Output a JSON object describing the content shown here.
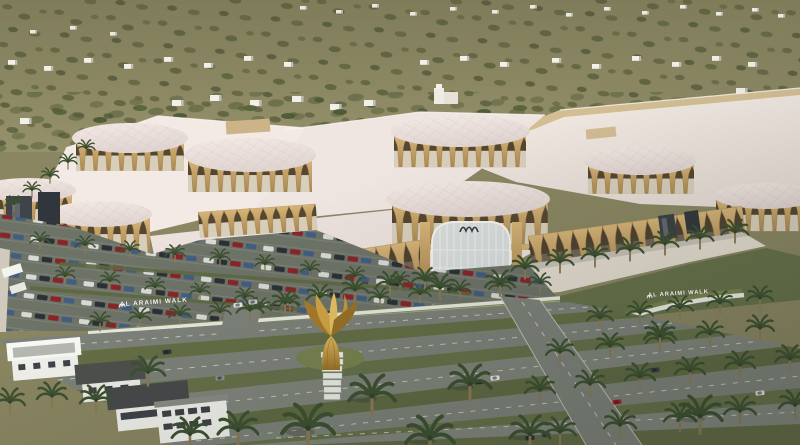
{
  "scene": {
    "description": "Aerial 3D architectural rendering of the Al Araimi Walk mall: white faceted roofs ringed by golden tulip-shaped colonnades, a glass entrance atrium, a golden flower monument with a directory sign, car-filled parking, palm-lined boulevards and desert hillside with white villas behind.",
    "signs": {
      "left_wall": "AL ARAIMI WALK",
      "right_wall": "AL ARAIMI WALK"
    },
    "palette": {
      "hillside": "#87845f",
      "roof_white": "#f1e9e3",
      "dome_pink": "#e9dedb",
      "column_gold": "#c9a76b",
      "arch_shadow": "#55462f",
      "parapet_tan": "#d5c094",
      "grass": "#66714a",
      "asphalt": "#6e7368",
      "road": "#7d827a",
      "palm_green": "#3d5130",
      "monument_gold": "#c9963e",
      "villa_white": "#f2f2ed"
    }
  }
}
